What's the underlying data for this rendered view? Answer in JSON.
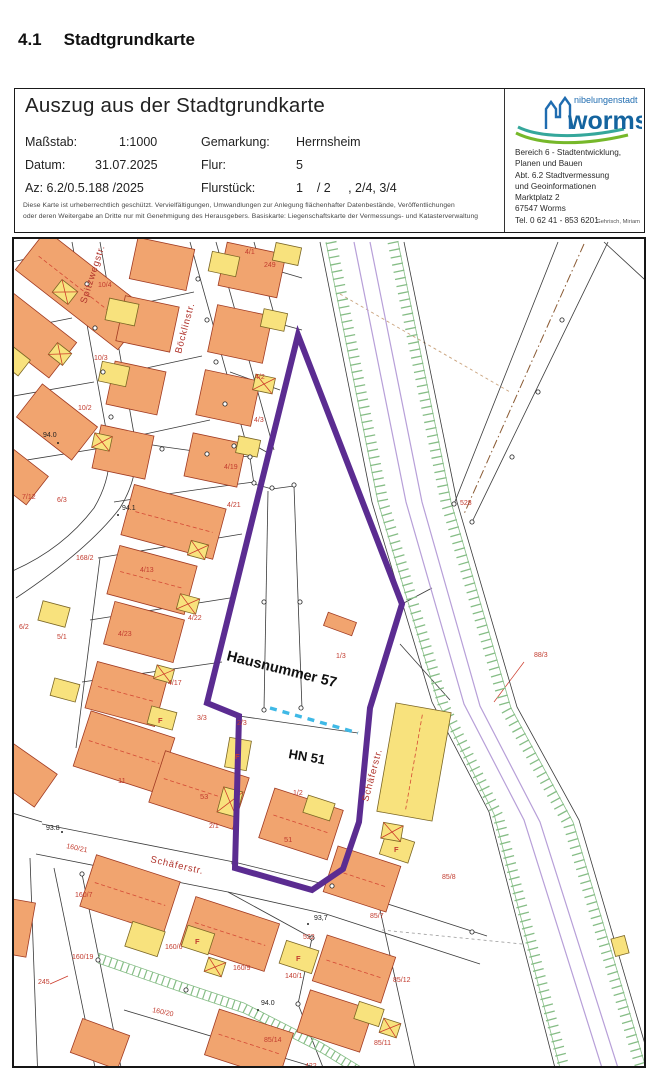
{
  "page": {
    "heading_number": "4.1",
    "heading_title": "Stadtgrundkarte"
  },
  "header": {
    "title": "Auszug aus der Stadtgrundkarte",
    "meta_left": [
      {
        "label": "Maßstab:",
        "value": "1:1000"
      },
      {
        "label": "Datum:",
        "value": "31.07.2025"
      },
      {
        "label": "Az: 6.2/0.5.188 /2025",
        "value": ""
      }
    ],
    "meta_right": [
      {
        "label": "Gemarkung:",
        "value": "Herrnsheim"
      },
      {
        "label": "Flur:",
        "value": "5"
      },
      {
        "label": "Flurstück:",
        "value": "1    / 2     , 2/4, 3/4"
      }
    ],
    "copyright_line1": "Diese Karte ist urheberrechtlich geschützt. Vervielfältigungen, Umwandlungen zur Anlegung flächenhafter Datenbestände, Veröffentlichungen",
    "copyright_line2": "oder deren Weitergabe an Dritte nur mit Genehmigung des Herausgebers. Basiskarte: Liegenschaftskarte der Vermessungs- und Katasterverwaltung",
    "office": {
      "logo_small": "nibelungenstadt",
      "logo_word": "worms",
      "address_lines": [
        "Bereich 6 - Stadtentwicklung,",
        "Planen und Bauen",
        "Abt. 6.2 Stadtvermessung",
        "und Geoinformationen",
        "Marktplatz 2",
        "67547 Worms",
        "Tel. 0 62 41 - 853 6201"
      ],
      "author": "Gehrisch, Miriam"
    }
  },
  "map": {
    "annotations": {
      "hausnummer": "Hausnummer 57",
      "hn": "HN 51"
    },
    "streets": [
      {
        "t": "Böcklinstr."
      },
      {
        "t": "Spitzwegstr."
      },
      {
        "t": "Schäferstr."
      },
      {
        "t": "Schäferstr."
      }
    ],
    "parcel_labels": [
      {
        "t": "10/4",
        "x": 96,
        "y": 285
      },
      {
        "t": "10/3",
        "x": 92,
        "y": 358
      },
      {
        "t": "10/2",
        "x": 76,
        "y": 408
      },
      {
        "t": "4/1",
        "x": 243,
        "y": 252
      },
      {
        "t": "249",
        "x": 262,
        "y": 265
      },
      {
        "t": "4/2",
        "x": 253,
        "y": 377
      },
      {
        "t": "4/3",
        "x": 252,
        "y": 420
      },
      {
        "t": "7/12",
        "x": 20,
        "y": 497
      },
      {
        "t": "6/3",
        "x": 55,
        "y": 500
      },
      {
        "t": "168/2",
        "x": 74,
        "y": 558
      },
      {
        "t": "4/19",
        "x": 222,
        "y": 467
      },
      {
        "t": "4/21",
        "x": 225,
        "y": 505
      },
      {
        "t": "4/13",
        "x": 138,
        "y": 570
      },
      {
        "t": "4/22",
        "x": 186,
        "y": 618
      },
      {
        "t": "4/23",
        "x": 116,
        "y": 634
      },
      {
        "t": "4/17",
        "x": 166,
        "y": 683
      },
      {
        "t": "6/2",
        "x": 17,
        "y": 627
      },
      {
        "t": "5/1",
        "x": 55,
        "y": 637
      },
      {
        "t": "2/3",
        "x": 235,
        "y": 723
      },
      {
        "t": "3/3",
        "x": 195,
        "y": 718
      },
      {
        "t": "2/1",
        "x": 207,
        "y": 826
      },
      {
        "t": "1/3",
        "x": 334,
        "y": 656
      },
      {
        "t": "1/2",
        "x": 291,
        "y": 793
      },
      {
        "t": "160/21",
        "x": 64,
        "y": 846,
        "r": 12
      },
      {
        "t": "160/7",
        "x": 73,
        "y": 895
      },
      {
        "t": "160/19",
        "x": 70,
        "y": 957
      },
      {
        "t": "160/6",
        "x": 163,
        "y": 947
      },
      {
        "t": "160/9",
        "x": 231,
        "y": 968
      },
      {
        "t": "160/20",
        "x": 150,
        "y": 1010,
        "r": 12
      },
      {
        "t": "140/1",
        "x": 283,
        "y": 976
      },
      {
        "t": "245",
        "x": 36,
        "y": 982
      },
      {
        "t": "522",
        "x": 301,
        "y": 937
      },
      {
        "t": "528",
        "x": 458,
        "y": 503
      },
      {
        "t": "88/3",
        "x": 532,
        "y": 655
      },
      {
        "t": "85/8",
        "x": 440,
        "y": 877
      },
      {
        "t": "85/7",
        "x": 368,
        "y": 916
      },
      {
        "t": "85/12",
        "x": 391,
        "y": 980
      },
      {
        "t": "85/11",
        "x": 372,
        "y": 1043
      },
      {
        "t": "85/14",
        "x": 262,
        "y": 1040
      },
      {
        "t": "422",
        "x": 303,
        "y": 1066
      }
    ],
    "elevation_labels": [
      {
        "t": "94.0",
        "x": 41,
        "y": 435
      },
      {
        "t": "94.1",
        "x": 120,
        "y": 508
      },
      {
        "t": "93.8",
        "x": 44,
        "y": 828
      },
      {
        "t": "93,7",
        "x": 312,
        "y": 918
      },
      {
        "t": "94.0",
        "x": 259,
        "y": 1003
      }
    ],
    "f_labels": [
      {
        "t": "F",
        "x": 233,
        "y": 757
      },
      {
        "t": "F",
        "x": 156,
        "y": 721
      },
      {
        "t": "F",
        "x": 392,
        "y": 850
      },
      {
        "t": "F",
        "x": 294,
        "y": 959
      },
      {
        "t": "F",
        "x": 193,
        "y": 942
      }
    ],
    "building_numbers": [
      {
        "t": "53",
        "x": 198,
        "y": 797
      },
      {
        "t": "11",
        "x": 116,
        "y": 781
      },
      {
        "t": "51",
        "x": 282,
        "y": 840
      }
    ],
    "colors": {
      "boundary_highlight": "#5b2c91",
      "planned_boundary": "#3fb9e6",
      "building_fill": "#f1a46f",
      "garage_fill": "#f8e27d",
      "embankment_hatch": "#86bd86",
      "track_lilac": "#b79fd8",
      "label_red": "#c23b2e",
      "logo_blue": "#14649f",
      "logo_teal": "#35a79b",
      "logo_green": "#76b82a"
    }
  }
}
